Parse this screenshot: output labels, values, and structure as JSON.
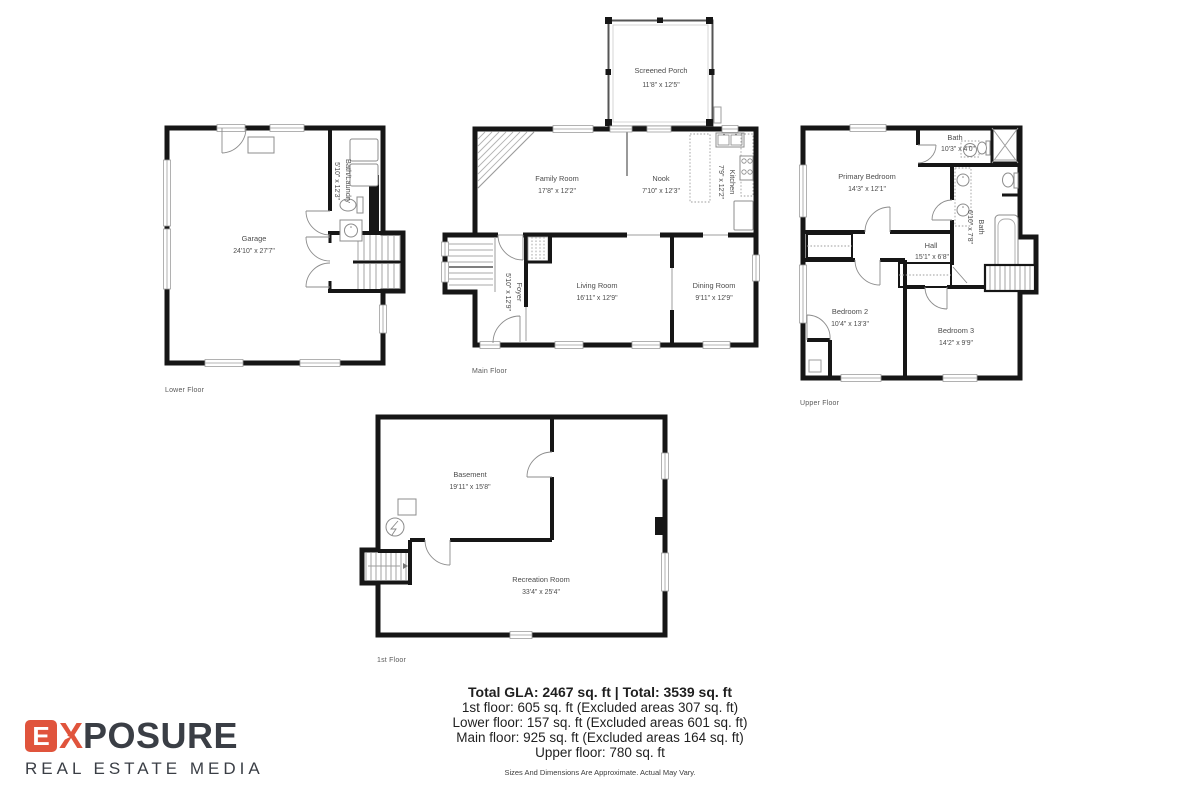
{
  "colors": {
    "accent": "#e0543c",
    "charcoal": "#3a3e45",
    "wall": "#161616",
    "room_text": "#4c4c4c"
  },
  "logo": {
    "e": "E",
    "x": "X",
    "rest": "POSURE",
    "tagline": "REAL ESTATE MEDIA"
  },
  "plans": {
    "lower": {
      "floor_label": "Lower Floor",
      "garage": {
        "name": "Garage",
        "dims": "24'10\" x 27'7\""
      },
      "bath_laundry": {
        "name": "Bath/Laundry",
        "dims": "5'10\" x 12'3\""
      }
    },
    "main": {
      "floor_label": "Main Floor",
      "screened_porch": {
        "name": "Screened Porch",
        "dims": "11'8\" x 12'5\""
      },
      "family_room": {
        "name": "Family Room",
        "dims": "17'8\" x 12'2\""
      },
      "nook": {
        "name": "Nook",
        "dims": "7'10\" x 12'3\""
      },
      "kitchen": {
        "name": "Kitchen",
        "dims": "7'9\" x 12'2\""
      },
      "foyer": {
        "name": "Foyer",
        "dims": "5'10\" x 12'9\""
      },
      "living_room": {
        "name": "Living Room",
        "dims": "16'11\" x 12'9\""
      },
      "dining_room": {
        "name": "Dining Room",
        "dims": "9'11\" x 12'9\""
      }
    },
    "upper": {
      "floor_label": "Upper Floor",
      "primary_bedroom": {
        "name": "Primary Bedroom",
        "dims": "14'3\" x 12'1\""
      },
      "bath1": {
        "name": "Bath",
        "dims": "10'3\" x 4'0\""
      },
      "bath2": {
        "name": "Bath",
        "dims": "6'10\" x 7'8\""
      },
      "hall": {
        "name": "Hall",
        "dims": "15'1\" x 6'8\""
      },
      "bedroom2": {
        "name": "Bedroom 2",
        "dims": "10'4\" x 13'3\""
      },
      "bedroom3": {
        "name": "Bedroom 3",
        "dims": "14'2\" x 9'9\""
      }
    },
    "first": {
      "floor_label": "1st Floor",
      "basement": {
        "name": "Basement",
        "dims": "19'11\" x 15'8\""
      },
      "recreation": {
        "name": "Recreation Room",
        "dims": "33'4\" x 25'4\""
      }
    }
  },
  "summary": {
    "title": "Total GLA: 2467 sq. ft | Total: 3539 sq. ft",
    "lines": [
      "1st floor: 605 sq. ft (Excluded areas 307 sq. ft)",
      "Lower floor: 157 sq. ft (Excluded areas 601 sq. ft)",
      "Main floor: 925 sq. ft (Excluded areas 164 sq. ft)",
      "Upper floor: 780 sq. ft"
    ],
    "disclaimer": "Sizes And Dimensions Are Approximate. Actual May Vary."
  }
}
